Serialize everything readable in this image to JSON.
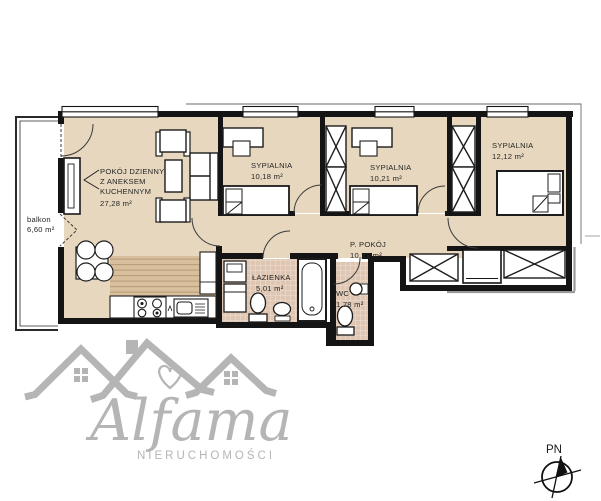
{
  "rooms": {
    "living": {
      "line1": "POKÓJ DZIENNY",
      "line2": "Z ANEKSEM",
      "line3": "KUCHENNYM",
      "area": "27,28 m²"
    },
    "bedroom1": {
      "name": "SYPIALNIA",
      "area": "10,18 m²"
    },
    "bedroom2": {
      "name": "SYPIALNIA",
      "area": "10,21 m²"
    },
    "bedroom3": {
      "name": "SYPIALNIA",
      "area": "12,12 m²"
    },
    "hallway": {
      "name": "P. POKÓJ",
      "area": "10,21 m²"
    },
    "bathroom": {
      "name": "ŁAZIENKA",
      "area": "5,01 m²"
    },
    "wc": {
      "name": "WC",
      "area": "1,78 m²"
    },
    "balcony": {
      "name": "balkon",
      "area": "6,60 m²"
    }
  },
  "compass": {
    "north_label": "PN"
  },
  "watermark": {
    "brand": "Alfama",
    "subtitle": "NIERUCHOMOŚCI"
  },
  "colors": {
    "floor": "#e6d7be",
    "wall": "#141414",
    "tile_base": "#dfc6b2",
    "tile_grout": "#efe0d4",
    "wood_base": "#d8c09e",
    "wood_line": "#bb9c77",
    "watermark_gray": "#b5b5b5",
    "shadow": "#9a9a9a"
  }
}
